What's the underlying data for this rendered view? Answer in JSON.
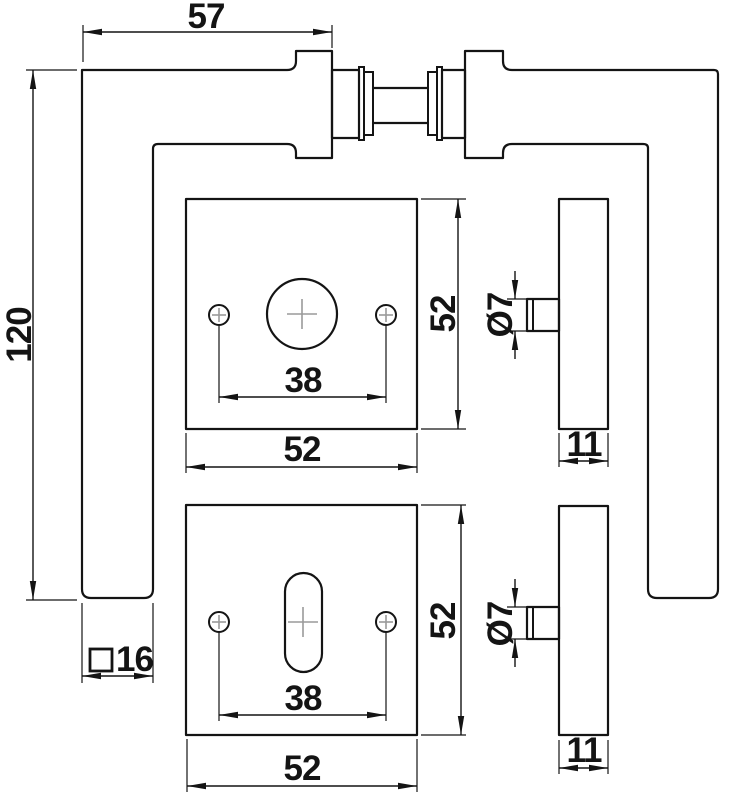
{
  "drawing": {
    "plan": {
      "projection": "57",
      "length": "120",
      "spindle_symbol": "□",
      "spindle_value": "16"
    },
    "rosette_top": {
      "width": "52",
      "height": "52",
      "screw_spacing": "38"
    },
    "rosette_bottom": {
      "width": "52",
      "height": "52",
      "screw_spacing": "38"
    },
    "side_top": {
      "pin_diameter": "Ø7",
      "thickness": "11"
    },
    "side_bottom": {
      "pin_diameter": "Ø7",
      "thickness": "11"
    },
    "colors": {
      "line": "#141414",
      "crosshair": "#9a9a9a",
      "background": "#ffffff"
    }
  }
}
